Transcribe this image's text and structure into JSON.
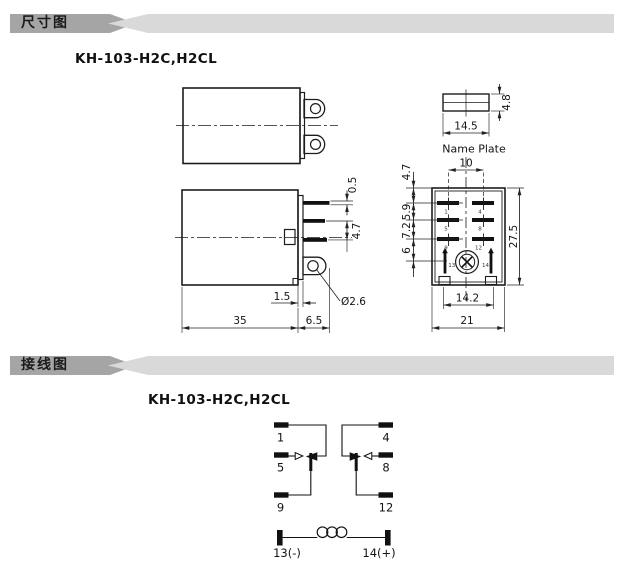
{
  "colors": {
    "banner_dark": "#a5a5a5",
    "banner_light": "#d9d9d9",
    "line": "#222222",
    "ink": "#111111",
    "background": "#ffffff"
  },
  "dimension_section": {
    "banner": "尺寸图",
    "model": "KH-103-H2C,H2CL",
    "side_view": {
      "pin_thickness": "0.5",
      "pin_pitch": "4.7",
      "step": "1.5",
      "body_length": "35",
      "pin_length": "6.5",
      "hole_dia": "Ø2.6"
    },
    "nameplate": {
      "width": "14.5",
      "thickness": "4.8",
      "caption": "Name Plate"
    },
    "bottom_view": {
      "pin_span": "10",
      "row_dims": [
        "4.7",
        "5.9",
        "7.2",
        "6"
      ],
      "height": "27.5",
      "inner_width": "14.2",
      "width": "21",
      "pin_numbers": [
        "1",
        "4",
        "5",
        "8",
        "9",
        "12",
        "13",
        "14"
      ]
    }
  },
  "wiring_section": {
    "banner": "接线图",
    "model": "KH-103-H2C,H2CL",
    "terminals": {
      "t1": "1",
      "t4": "4",
      "t5": "5",
      "t8": "8",
      "t9": "9",
      "t12": "12",
      "t13": "13(-)",
      "t14": "14(+)"
    }
  }
}
